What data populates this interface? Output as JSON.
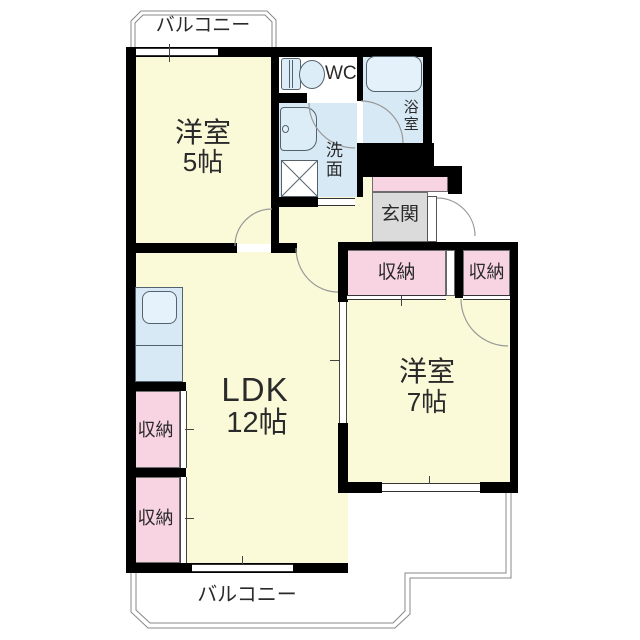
{
  "floorplan": {
    "kind": "2LDK apartment floor plan",
    "balconies": {
      "top": "バルコニー",
      "bottom": "バルコニー"
    },
    "rooms": {
      "western5": {
        "name": "洋室",
        "size": "5帖"
      },
      "wc": {
        "name": "WC"
      },
      "bath": {
        "name": "浴室"
      },
      "washroom": {
        "name": "洗面"
      },
      "entrance": {
        "name": "玄関"
      },
      "ldk": {
        "name": "LDK",
        "size": "12帖"
      },
      "western7": {
        "name": "洋室",
        "size": "7帖"
      },
      "closet_hall_large": {
        "name": "収納"
      },
      "closet_hall_small": {
        "name": "収納"
      },
      "closet_ldk_upper": {
        "name": "収納"
      },
      "closet_ldk_lower": {
        "name": "収納"
      }
    },
    "colors": {
      "room_floor": "#FAFAD9",
      "wet_area_floor": "#D8E9F6",
      "fixture_fill": "#DDEDF8",
      "closet_fill": "#F8D4E2",
      "entrance_step": "#F8D4E2",
      "entrance_floor": "#DBDBDB",
      "wall": "#000000",
      "outline": "#888888",
      "text": "#2A2A2A"
    }
  }
}
